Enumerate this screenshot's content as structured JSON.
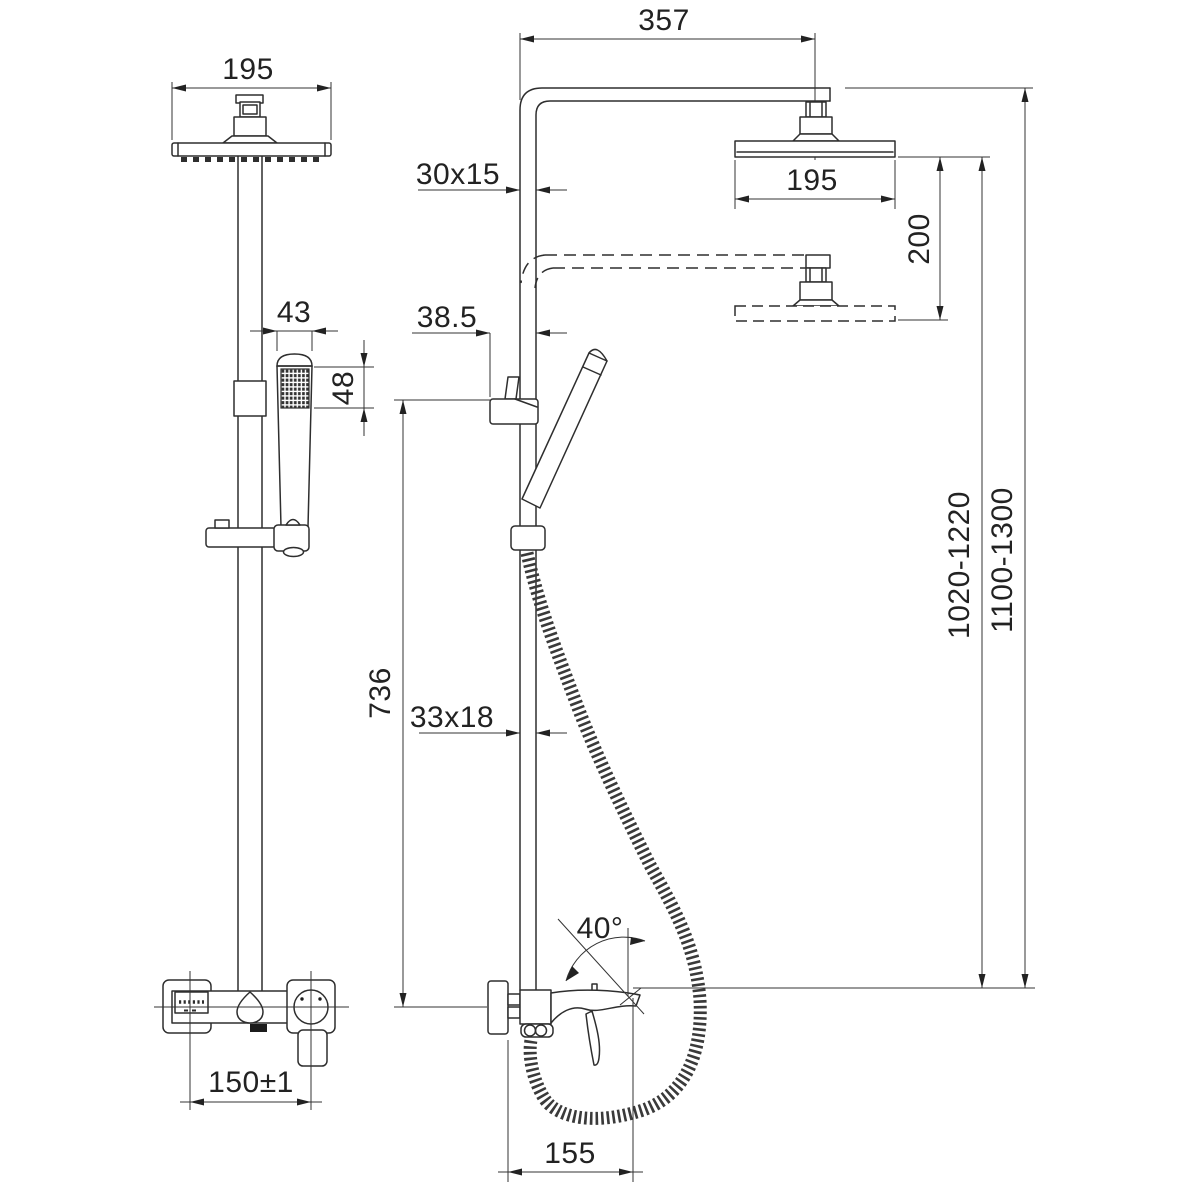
{
  "drawing": {
    "title": "shower-column-dimension-drawing",
    "background_color": "#ffffff",
    "line_color": "#2e2e2e",
    "front_view": {
      "head_width": "195",
      "hand_shower_width": "43",
      "spray_face_height": "48",
      "supply_centers": "150±1"
    },
    "side_view": {
      "arm_reach": "357",
      "upper_pipe_profile": "30x15",
      "head_depth": "195",
      "height_adjustment": "200",
      "holder_offset": "38.5",
      "rail_length": "736",
      "lower_pipe_profile": "33x18",
      "rail_height_range": "1020-1220",
      "overall_height_range": "1100-1300",
      "handle_angle": "40°",
      "hose_connection_offset": "155"
    }
  }
}
